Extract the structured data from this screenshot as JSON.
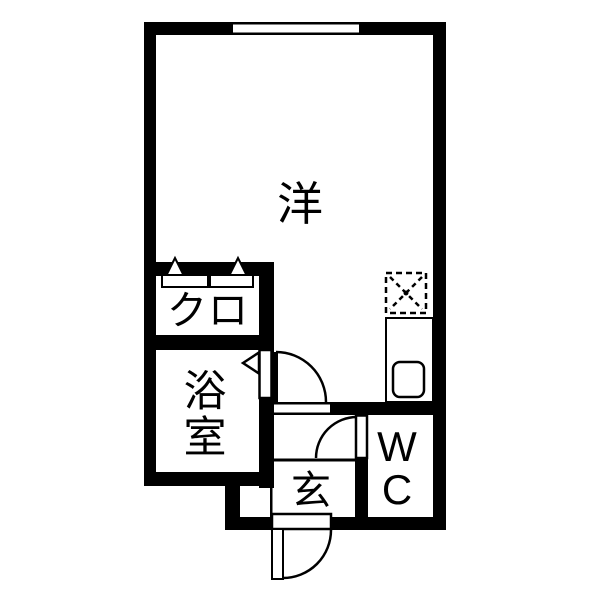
{
  "plan": {
    "type": "japanese-apartment-floorplan",
    "colors": {
      "wall": "#000000",
      "floor": "#ffffff",
      "line": "#000000"
    },
    "rooms": {
      "main": {
        "label": "洋"
      },
      "closet": {
        "label": "クロ"
      },
      "bathroom": {
        "label": "浴室",
        "char1": "浴",
        "char2": "室"
      },
      "entrance": {
        "label": "玄"
      },
      "toilet": {
        "label": "WC",
        "char1": "W",
        "char2": "C"
      }
    },
    "fixtures": {
      "window": "top-wall-window",
      "stove": "dashed-stove-square",
      "counter": "kitchen-counter",
      "sink": "kitchen-sink",
      "hangers": "closet-hanger-triangles",
      "shelf": "closet-shelf-bars",
      "doors": [
        "main-room-door",
        "bathroom-door",
        "wc-door",
        "entrance-door"
      ],
      "step": "genkan-step-line"
    }
  }
}
